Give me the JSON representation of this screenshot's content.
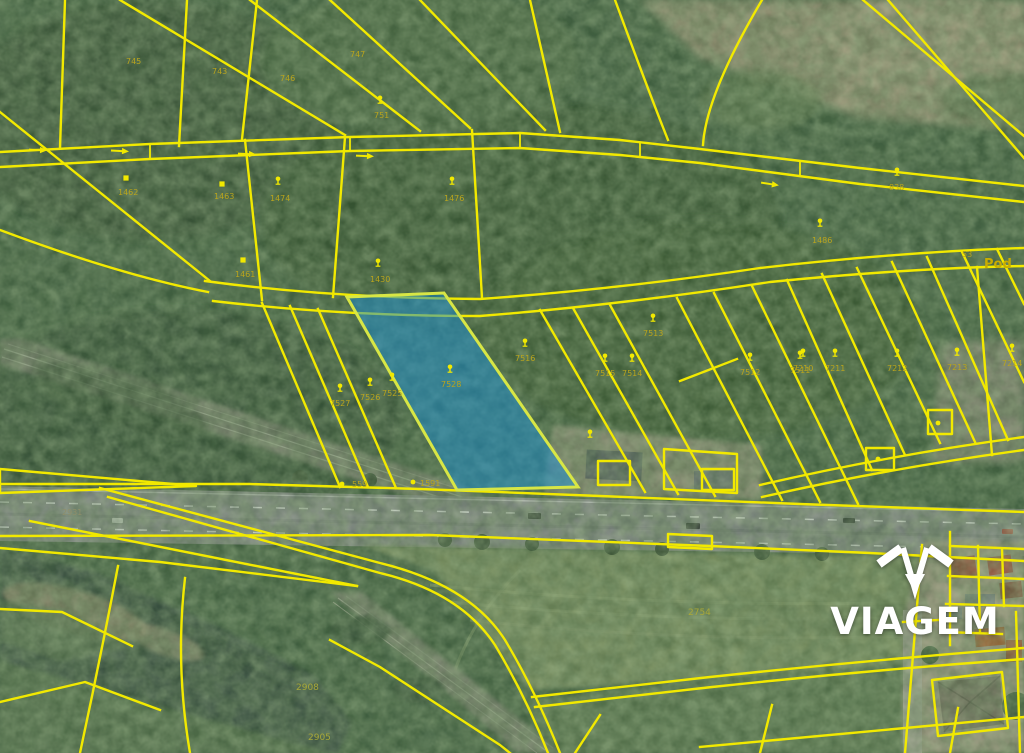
{
  "map": {
    "watermark_text": "VIAGEM",
    "street_label": {
      "text": "Pod",
      "x": 984,
      "y": 268
    },
    "area_label": {
      "text": "53",
      "x": 962,
      "y": 257
    },
    "highlight_parcel": {
      "name": "selected-parcel"
    },
    "colors": {
      "parcel_line": "#f2e900",
      "highlight_fill": "#1e8fd0",
      "highlight_stroke": "#d8e645",
      "watermark": "#ffffff",
      "label": "#b9a41d"
    },
    "labels": [
      {
        "t": "745",
        "x": 126,
        "y": 64
      },
      {
        "t": "743",
        "x": 212,
        "y": 74
      },
      {
        "t": "746",
        "x": 280,
        "y": 81
      },
      {
        "t": "747",
        "x": 350,
        "y": 57
      },
      {
        "t": "751",
        "x": 374,
        "y": 118
      },
      {
        "t": "838",
        "x": 889,
        "y": 190
      },
      {
        "t": "1486",
        "x": 812,
        "y": 243
      },
      {
        "t": "1462",
        "x": 118,
        "y": 195
      },
      {
        "t": "1463",
        "x": 214,
        "y": 199
      },
      {
        "t": "1474",
        "x": 270,
        "y": 201
      },
      {
        "t": "1476",
        "x": 444,
        "y": 201
      },
      {
        "t": "1461",
        "x": 235,
        "y": 277
      },
      {
        "t": "1430",
        "x": 370,
        "y": 282
      },
      {
        "t": "7527",
        "x": 330,
        "y": 406
      },
      {
        "t": "7526",
        "x": 360,
        "y": 400
      },
      {
        "t": "7525",
        "x": 382,
        "y": 396
      },
      {
        "t": "7528",
        "x": 441,
        "y": 387
      },
      {
        "t": "7516",
        "x": 515,
        "y": 361
      },
      {
        "t": "7515",
        "x": 595,
        "y": 376
      },
      {
        "t": "7514",
        "x": 622,
        "y": 376
      },
      {
        "t": "7513",
        "x": 643,
        "y": 336
      },
      {
        "t": "7512",
        "x": 740,
        "y": 375
      },
      {
        "t": "7511",
        "x": 790,
        "y": 373
      },
      {
        "t": "7210",
        "x": 793,
        "y": 371
      },
      {
        "t": "7211",
        "x": 825,
        "y": 371
      },
      {
        "t": "7212",
        "x": 887,
        "y": 371
      },
      {
        "t": "7213",
        "x": 947,
        "y": 370
      },
      {
        "t": "7214",
        "x": 1002,
        "y": 366
      },
      {
        "t": "559",
        "x": 352,
        "y": 487
      },
      {
        "t": "1591",
        "x": 420,
        "y": 486
      },
      {
        "t": "2754",
        "x": 688,
        "y": 615,
        "c": "f"
      },
      {
        "t": "2908",
        "x": 296,
        "y": 690,
        "c": "f"
      },
      {
        "t": "2905",
        "x": 308,
        "y": 740,
        "c": "f"
      },
      {
        "t": "2931",
        "x": 62,
        "y": 515,
        "c": "r"
      }
    ],
    "icons": [
      {
        "type": "building-icon",
        "x": 126,
        "y": 178
      },
      {
        "type": "building-icon",
        "x": 222,
        "y": 184
      },
      {
        "type": "tree-icon",
        "x": 278,
        "y": 183
      },
      {
        "type": "tree-icon",
        "x": 452,
        "y": 183
      },
      {
        "type": "building-icon",
        "x": 243,
        "y": 260
      },
      {
        "type": "tree-icon",
        "x": 378,
        "y": 265
      },
      {
        "type": "tree-icon",
        "x": 380,
        "y": 102
      },
      {
        "type": "tree-icon",
        "x": 897,
        "y": 174
      },
      {
        "type": "tree-icon",
        "x": 820,
        "y": 225
      },
      {
        "type": "tree-icon",
        "x": 340,
        "y": 390
      },
      {
        "type": "tree-icon",
        "x": 370,
        "y": 384
      },
      {
        "type": "tree-icon",
        "x": 392,
        "y": 379
      },
      {
        "type": "tree-icon",
        "x": 450,
        "y": 371
      },
      {
        "type": "tree-icon",
        "x": 525,
        "y": 345
      },
      {
        "type": "tree-icon",
        "x": 605,
        "y": 360
      },
      {
        "type": "tree-icon",
        "x": 632,
        "y": 360
      },
      {
        "type": "tree-icon",
        "x": 653,
        "y": 320
      },
      {
        "type": "tree-icon",
        "x": 750,
        "y": 359
      },
      {
        "type": "tree-icon",
        "x": 800,
        "y": 357
      },
      {
        "type": "tree-icon",
        "x": 803,
        "y": 355
      },
      {
        "type": "tree-icon",
        "x": 835,
        "y": 355
      },
      {
        "type": "tree-icon",
        "x": 897,
        "y": 355
      },
      {
        "type": "tree-icon",
        "x": 957,
        "y": 354
      },
      {
        "type": "tree-icon",
        "x": 1012,
        "y": 350
      },
      {
        "type": "tree-icon",
        "x": 590,
        "y": 436
      },
      {
        "type": "dot-icon",
        "x": 342,
        "y": 484
      },
      {
        "type": "dot-icon",
        "x": 413,
        "y": 482
      },
      {
        "type": "dot-icon",
        "x": 938,
        "y": 423
      },
      {
        "type": "dot-icon",
        "x": 878,
        "y": 459
      },
      {
        "type": "arrow-icon",
        "x": 120,
        "y": 151,
        "a": 3
      },
      {
        "type": "arrow-icon",
        "x": 247,
        "y": 154,
        "a": 2
      },
      {
        "type": "arrow-icon",
        "x": 365,
        "y": 156,
        "a": 2
      },
      {
        "type": "arrow-icon",
        "x": 770,
        "y": 184,
        "a": 9
      },
      {
        "type": "arrow-icon",
        "x": 38,
        "y": 150,
        "a": 2
      }
    ]
  }
}
